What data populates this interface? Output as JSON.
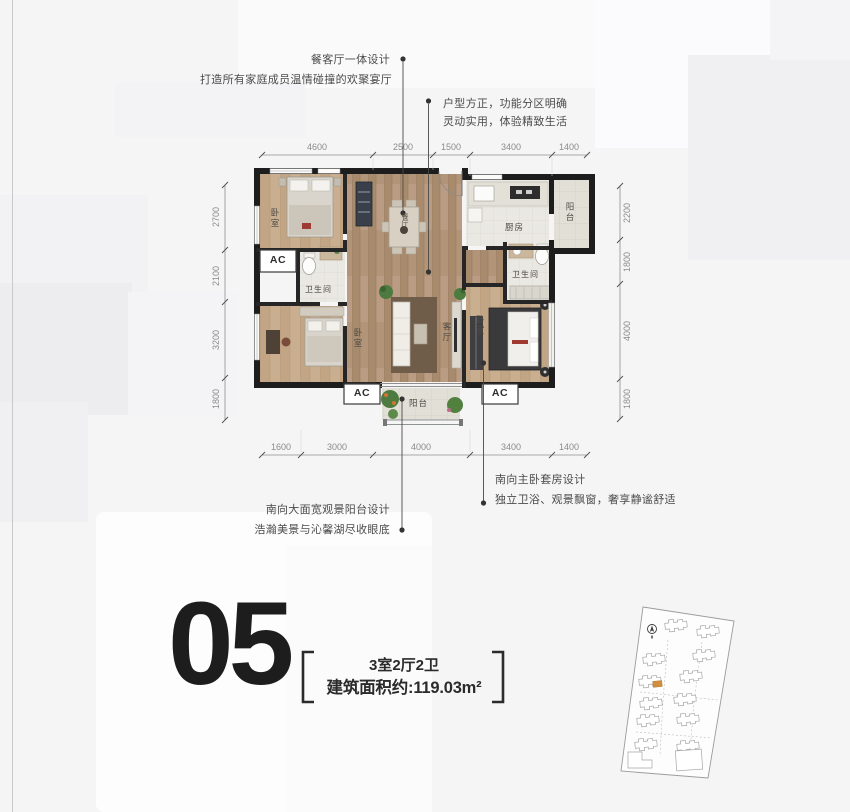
{
  "unit": {
    "number": "05",
    "type": "3室2厅2卫",
    "area": "建筑面积约:119.03m²"
  },
  "annotations": {
    "dining_title": "餐客厅一体设计",
    "dining_sub": "打造所有家庭成员温情碰撞的欢聚宴厅",
    "layout_line1": "户型方正，功能分区明确",
    "layout_line2": "灵动实用，体验精致生活",
    "balcony_title": "南向大面宽观景阳台设计",
    "balcony_sub": "浩瀚美景与沁馨湖尽收眼底",
    "master_title": "南向主卧套房设计",
    "master_sub": "独立卫浴、观景飘窗，奢享静谧舒适"
  },
  "dimensions": {
    "top": [
      "4600",
      "2500",
      "1500",
      "3400",
      "1400"
    ],
    "bottom": [
      "1600",
      "3000",
      "4000",
      "3400",
      "1400"
    ],
    "left": [
      "2700",
      "2100",
      "3200",
      "1800"
    ],
    "right": [
      "2200",
      "1800",
      "4000",
      "1800"
    ]
  },
  "rooms": {
    "bedroom": "卧室",
    "bathroom": "卫生间",
    "kitchen": "厨房",
    "balcony": "阳台",
    "living": "客厅",
    "dining": "餐厅",
    "ac": "AC"
  },
  "colors": {
    "wall": "#1d1d1d",
    "wood_floor": "#b09376",
    "bedroom_floor": "#c8ae90",
    "tile_floor": "#eae8e2",
    "accent_building": "#cf8f3e",
    "annotation_text": "#4c4c4c",
    "dimension_text": "#8b8b8b"
  }
}
